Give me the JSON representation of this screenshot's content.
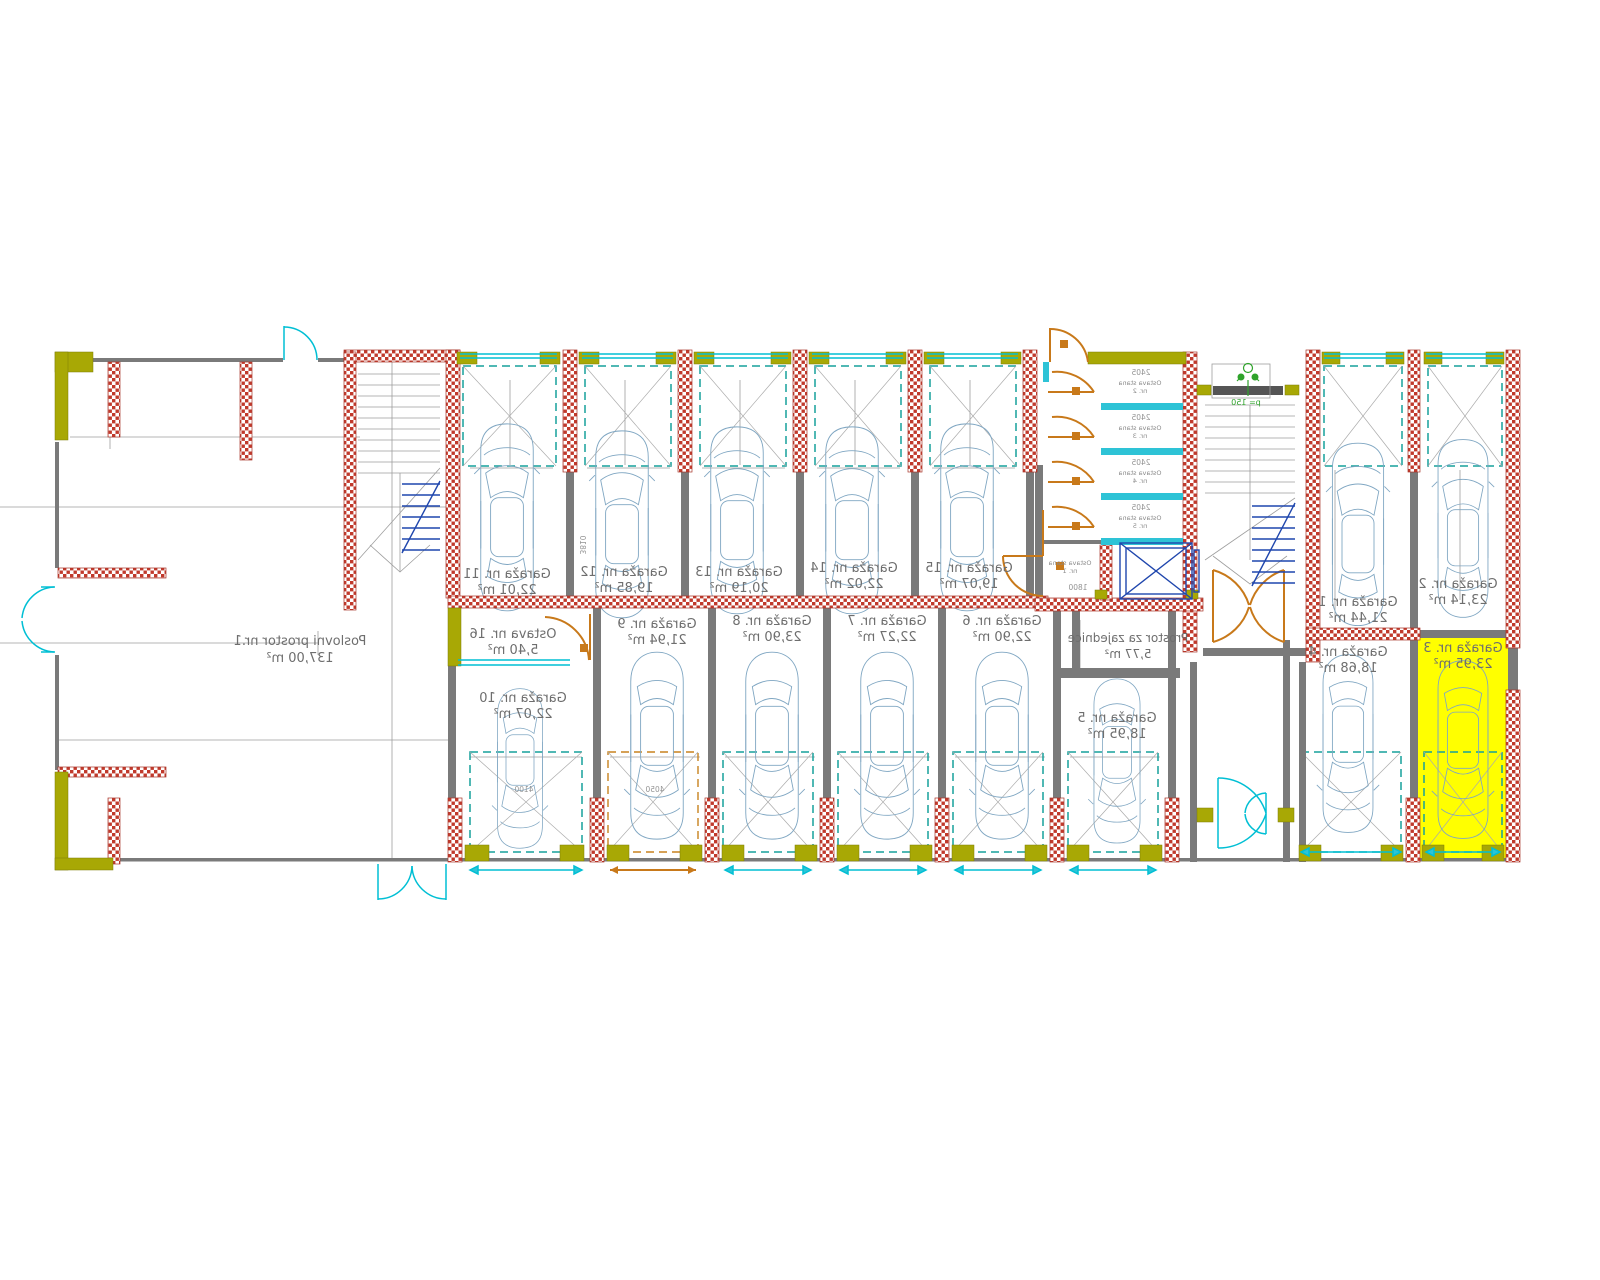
{
  "drawing": {
    "kind": "garage-level architectural floor plan (CAD)",
    "highlight_color": "#ffff00",
    "colors": {
      "wall_brick": "#c0392b",
      "wall_lintel_olive": "#a8a805",
      "wall_partition_gray": "#7a7a7a",
      "door_line_cyan": "#00bfd4",
      "opening_zone_teal": "#17a09b",
      "opening_zone_orange": "#c8821e",
      "car_outline": "#7fa6c2",
      "stair_flight_blue": "#1f46ad",
      "greenery": "#2fa32b"
    }
  },
  "rooms": {
    "poslovni": {
      "name": "Poslovni prostor nr.1",
      "area": "137,00 m²"
    },
    "g1": {
      "name": "Garaža nr. 1",
      "area": "21,44 m²"
    },
    "g2": {
      "name": "Garaža nr. 2",
      "area": "23,14 m²"
    },
    "g3": {
      "name": "Garaža nr. 3",
      "area": "23,95 m²"
    },
    "g4": {
      "name": "Garaža nr. 4",
      "area": "18,68 m²"
    },
    "g5": {
      "name": "Garaža nr. 5",
      "area": "18,95 m²"
    },
    "g6": {
      "name": "Garaža nr. 6",
      "area": "22,90 m²"
    },
    "g7": {
      "name": "Garaža nr. 7",
      "area": "22,27 m²"
    },
    "g8": {
      "name": "Garaža nr. 8",
      "area": "23,90 m²"
    },
    "g9": {
      "name": "Garaža nr. 9",
      "area": "21,94 m²"
    },
    "g10": {
      "name": "Garaža nr. 10",
      "area": "22,07 m²"
    },
    "g11": {
      "name": "Garaža nr. 11",
      "area": "22,01 m²"
    },
    "g12": {
      "name": "Garaža nr. 12",
      "area": "19,85 m²"
    },
    "g13": {
      "name": "Garaža nr. 13",
      "area": "20,19 m²"
    },
    "g14": {
      "name": "Garaža nr. 14",
      "area": "22,02 m²"
    },
    "g15": {
      "name": "Garaža nr. 15",
      "area": "19,07 m²"
    },
    "ostava16": {
      "name": "Ostava nr. 16",
      "area": "5,40 m²"
    },
    "prostor": {
      "name": "Prostor za zajednice",
      "area": "5,77 m²"
    }
  },
  "storages": [
    {
      "line1": "Ostava stana",
      "line2": "nr. 2"
    },
    {
      "line1": "Ostava stana",
      "line2": "nr. 3"
    },
    {
      "line1": "Ostava stana",
      "line2": "nr. 4"
    },
    {
      "line1": "Ostava stana",
      "line2": "nr. 5"
    },
    {
      "line1": "Ostava stana",
      "line2": "nr. 1"
    }
  ],
  "dims": {
    "storage_width": "2405",
    "elevator_room_width": "1800",
    "planter": "p= 150",
    "garage9_door": "4050",
    "garage10_door": "4100",
    "bay12_depth": "3810"
  }
}
